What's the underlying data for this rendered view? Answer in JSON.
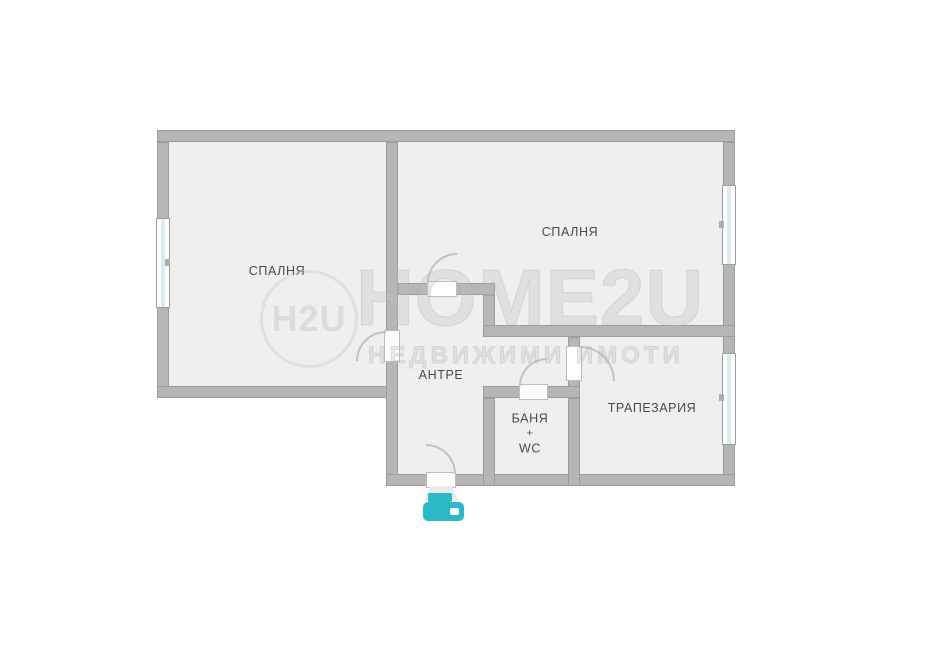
{
  "canvas": {
    "width": 931,
    "height": 648,
    "background": "#ffffff"
  },
  "palette": {
    "wall_fill": "#b6b6b6",
    "wall_edge": "#9d9d9d",
    "floor": "#efefee",
    "window_glass": "#d9ecf0",
    "door_arc": "#c2c2c2",
    "label_text": "#4a4a4a",
    "watermark_gray": "#bcbcbc",
    "icon_teal": "#29b9c7"
  },
  "rooms": {
    "bedroom1": {
      "label": "СПАЛНЯ"
    },
    "bedroom2": {
      "label": "СПАЛНЯ"
    },
    "hallway": {
      "label": "АНТРЕ"
    },
    "bathroom": {
      "line1": "БАНЯ",
      "line2": "+",
      "line3": "WC"
    },
    "dining": {
      "label": "ТРАПЕЗАРИЯ"
    }
  },
  "watermark": {
    "logo_text": "H2U",
    "title": "HOME2U",
    "subtitle": "НЕДВИЖИМИ ИМОТИ"
  },
  "entrance_icon": {
    "name": "printer-icon",
    "color": "#29b9c7"
  },
  "plan_geometry": {
    "floors": [
      {
        "x": 157,
        "y": 130,
        "w": 241,
        "h": 268
      },
      {
        "x": 386,
        "y": 130,
        "w": 349,
        "h": 207
      },
      {
        "x": 386,
        "y": 283,
        "w": 349,
        "h": 203
      }
    ],
    "walls": [
      {
        "name": "wall-top",
        "x": 157,
        "y": 130,
        "w": 578,
        "h": 12
      },
      {
        "name": "wall-left",
        "x": 157,
        "y": 142,
        "w": 12,
        "h": 256
      },
      {
        "name": "wall-bedroom1-bottom",
        "x": 157,
        "y": 386,
        "w": 241,
        "h": 12
      },
      {
        "name": "wall-bedrooms-divider",
        "x": 386,
        "y": 142,
        "w": 12,
        "h": 344
      },
      {
        "name": "wall-right",
        "x": 723,
        "y": 142,
        "w": 12,
        "h": 344
      },
      {
        "name": "wall-bottom",
        "x": 386,
        "y": 474,
        "w": 349,
        "h": 12
      },
      {
        "name": "wall-hall-top",
        "x": 398,
        "y": 283,
        "w": 97,
        "h": 12
      },
      {
        "name": "wall-step",
        "x": 483,
        "y": 295,
        "w": 12,
        "h": 42
      },
      {
        "name": "wall-bedroom2-bottom",
        "x": 483,
        "y": 325,
        "w": 252,
        "h": 12
      },
      {
        "name": "wall-corridor-dining",
        "x": 568,
        "y": 337,
        "w": 12,
        "h": 61
      },
      {
        "name": "wall-bath-top",
        "x": 483,
        "y": 386,
        "w": 97,
        "h": 12
      },
      {
        "name": "wall-bath-left",
        "x": 483,
        "y": 398,
        "w": 12,
        "h": 88
      },
      {
        "name": "wall-bath-right",
        "x": 568,
        "y": 398,
        "w": 12,
        "h": 88
      }
    ],
    "windows": [
      {
        "name": "window-bedroom1",
        "x": 156,
        "y": 218,
        "w": 14,
        "h": 90
      },
      {
        "name": "window-bedroom2",
        "x": 722,
        "y": 185,
        "w": 14,
        "h": 80
      },
      {
        "name": "window-dining",
        "x": 722,
        "y": 353,
        "w": 14,
        "h": 92
      }
    ],
    "door_openings": [
      {
        "name": "door-bedroom1",
        "x": 384,
        "y": 330,
        "w": 16,
        "h": 32
      },
      {
        "name": "door-bedroom2",
        "x": 427,
        "y": 281,
        "w": 30,
        "h": 16
      },
      {
        "name": "door-bathroom",
        "x": 519,
        "y": 384,
        "w": 29,
        "h": 16
      },
      {
        "name": "door-dining",
        "x": 566,
        "y": 346,
        "w": 16,
        "h": 35
      },
      {
        "name": "door-entrance",
        "x": 426,
        "y": 472,
        "w": 30,
        "h": 16
      }
    ],
    "door_arcs": [
      {
        "name": "swing-bedroom1",
        "x": 356,
        "y": 331,
        "w": 30,
        "h": 30,
        "corner": "tl"
      },
      {
        "name": "swing-bedroom2",
        "x": 427,
        "y": 253,
        "w": 30,
        "h": 30,
        "corner": "tl"
      },
      {
        "name": "swing-bathroom",
        "x": 519,
        "y": 358,
        "w": 28,
        "h": 28,
        "corner": "tl"
      },
      {
        "name": "swing-dining",
        "x": 580,
        "y": 346,
        "w": 35,
        "h": 35,
        "corner": "tr"
      },
      {
        "name": "swing-entrance",
        "x": 426,
        "y": 444,
        "w": 30,
        "h": 30,
        "corner": "tr"
      }
    ],
    "marks": [
      {
        "x": 165,
        "y": 259,
        "w": 5,
        "h": 7
      },
      {
        "x": 719,
        "y": 221,
        "w": 5,
        "h": 7
      },
      {
        "x": 719,
        "y": 394,
        "w": 5,
        "h": 7
      }
    ],
    "wedge": {
      "x": 424,
      "y": 486,
      "w": 34,
      "h": 15
    }
  }
}
